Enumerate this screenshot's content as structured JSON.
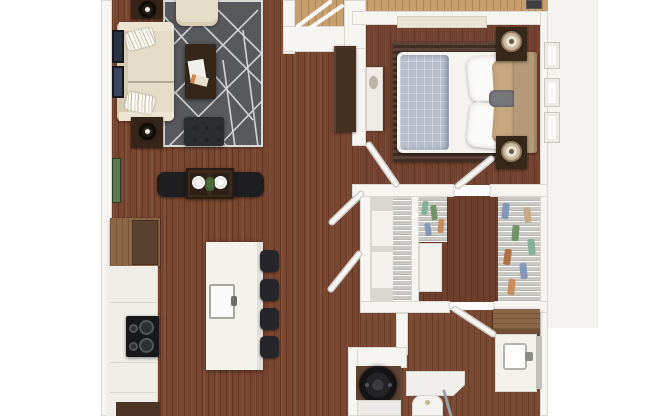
{
  "image_type": "3d-apartment-floor-plan",
  "description": "Top-down 3D rendering of a one-bedroom apartment floor plan with open living, dining and kitchen area on the left, bedroom at top right, closets at middle right, and bathroom with laundry at bottom right. No text labels are rendered in the image.",
  "rooms": [
    {
      "name": "living-room",
      "furniture": [
        "cream-sofa-with-pillows",
        "cream-armchair",
        "dark-coffee-table-with-magazines",
        "tufted-ottoman",
        "two-side-tables-with-dark-globe-lamps",
        "gray-lattice-area-rug",
        "wall-art-frames",
        "tall-green-wall-art",
        "entry-wardrobe-cabinet"
      ]
    },
    {
      "name": "dining-area",
      "furniture": [
        "dark-square-table",
        "two-black-chairs",
        "two-white-place-settings",
        "green-centerpiece"
      ]
    },
    {
      "name": "kitchen",
      "furniture": [
        "wood-counter",
        "refrigerator",
        "black-cooktop-with-burners",
        "white-cabinet-run",
        "white-island-with-sink",
        "four-black-bar-stools"
      ]
    },
    {
      "name": "entry",
      "furniture": [
        "exterior-landing",
        "railing",
        "door-mat"
      ]
    },
    {
      "name": "bedroom",
      "furniture": [
        "bed-with-white-comforter",
        "blue-gray-folded-duvet",
        "tan-and-white-pillows",
        "tan-headboard",
        "two-nightstands-with-cream-lamps",
        "long-cream-dresser",
        "white-side-dresser",
        "striped-area-rug",
        "windows-on-right-wall"
      ]
    },
    {
      "name": "linen-closet",
      "furniture": [
        "white-storage-boxes",
        "wire-shelving",
        "double-doors"
      ]
    },
    {
      "name": "walk-in-closet",
      "furniture": [
        "hanging-clothes-left-rod",
        "hanging-clothes-right-rod",
        "white-dresser",
        "wire-shelving"
      ]
    },
    {
      "name": "bathroom",
      "furniture": [
        "wood-linen-cabinet",
        "white-vanity-with-sink",
        "mirror",
        "shower-enclosure",
        "toilet",
        "towel"
      ]
    },
    {
      "name": "laundry-closet",
      "furniture": [
        "front-load-washer-dryer"
      ]
    }
  ],
  "palette": {
    "wood_living": "#7b4630",
    "wood_bedroom": "#75432f",
    "wood_closet": "#6e3f2d",
    "wood_bath": "#7b4a33",
    "wood_walkway": "#c79e6d",
    "wood_counter": "#8b6747",
    "wall": "#f6f5f2",
    "wall_edge": "#dbd8d1",
    "ext": "#f4f3f0",
    "rug": "#57595d",
    "rug_line": "#d9dadb",
    "sofa": "#e5dcc8",
    "sofa_shade": "#d7cbb2",
    "espresso": "#352619",
    "table_dark": "#3a2a1e",
    "chair_black": "#1e1e20",
    "ottoman": "#2c2d31",
    "island": "#f3f2ec",
    "counter_white": "#f0eee8",
    "fridge": "#5a4130",
    "cooktop": "#17181a",
    "steel": "#9a9a94",
    "bed_white": "#f4f3ef",
    "duvet": "#b7bfcc",
    "headboard": "#b49a78",
    "pillow_tan": "#c6a87f",
    "lumbar": "#77787c",
    "nightstand": "#38281a",
    "lamp_cream": "#cbb89f",
    "dresser_cream": "#e9e3d3",
    "closet_floor": "#d8d7d2",
    "shelf_white": "#f3f2ee",
    "washer": "#1a1a1c",
    "green_art": "#5c7a50",
    "art_navy": "#2b3140",
    "mat_dark": "#3f3e40",
    "cloth_teal": "#7fae9b",
    "cloth_green": "#6f8f66",
    "cloth_orange": "#c98a56",
    "cloth_blue": "#7d95b5",
    "cloth_tan": "#c4a883",
    "cloth_rust": "#b06a3e"
  }
}
